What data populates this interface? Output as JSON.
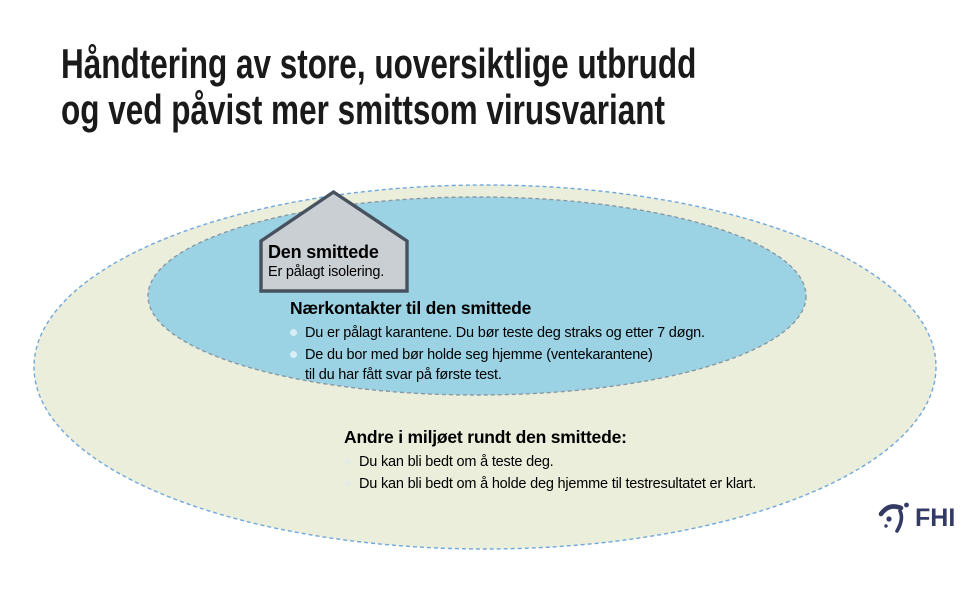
{
  "title": {
    "line1": "Håndtering av store, uoversiktlige utbrudd",
    "line2": "og ved påvist mer smittsom virusvariant"
  },
  "diagram": {
    "house": {
      "name": "Den smittede",
      "subtitle": "Er pålagt isolering."
    },
    "inner_zone": {
      "heading": "Nærkontakter til den smittede",
      "bullets": [
        "Du er pålagt karantene. Du bør teste deg straks og etter 7 døgn.",
        "De du bor med bør holde seg hjemme (ventekarantene)\ntil du har fått svar på første test."
      ]
    },
    "outer_zone": {
      "heading": "Andre i miljøet rundt den smittede:",
      "bullets": [
        "Du kan bli bedt om å teste deg.",
        "Du kan bli bedt om å holde deg hjemme til testresultatet er klart."
      ]
    }
  },
  "logo": {
    "text": "FHI",
    "icon": "fhi-figure-icon"
  },
  "colors": {
    "title_text": "#1a1a1a",
    "outer_ellipse_fill": "#eaeedb",
    "outer_ellipse_stroke": "#6fa8dc",
    "inner_ellipse_fill": "#9bd3e5",
    "inner_ellipse_stroke": "#8a98a3",
    "house_fill": "#cacfd4",
    "house_stroke": "#47525e",
    "bullet_inner": "#d9edf5",
    "bullet_outer": "#e6ece2",
    "logo_navy": "#333a64",
    "body_text": "#000000"
  }
}
